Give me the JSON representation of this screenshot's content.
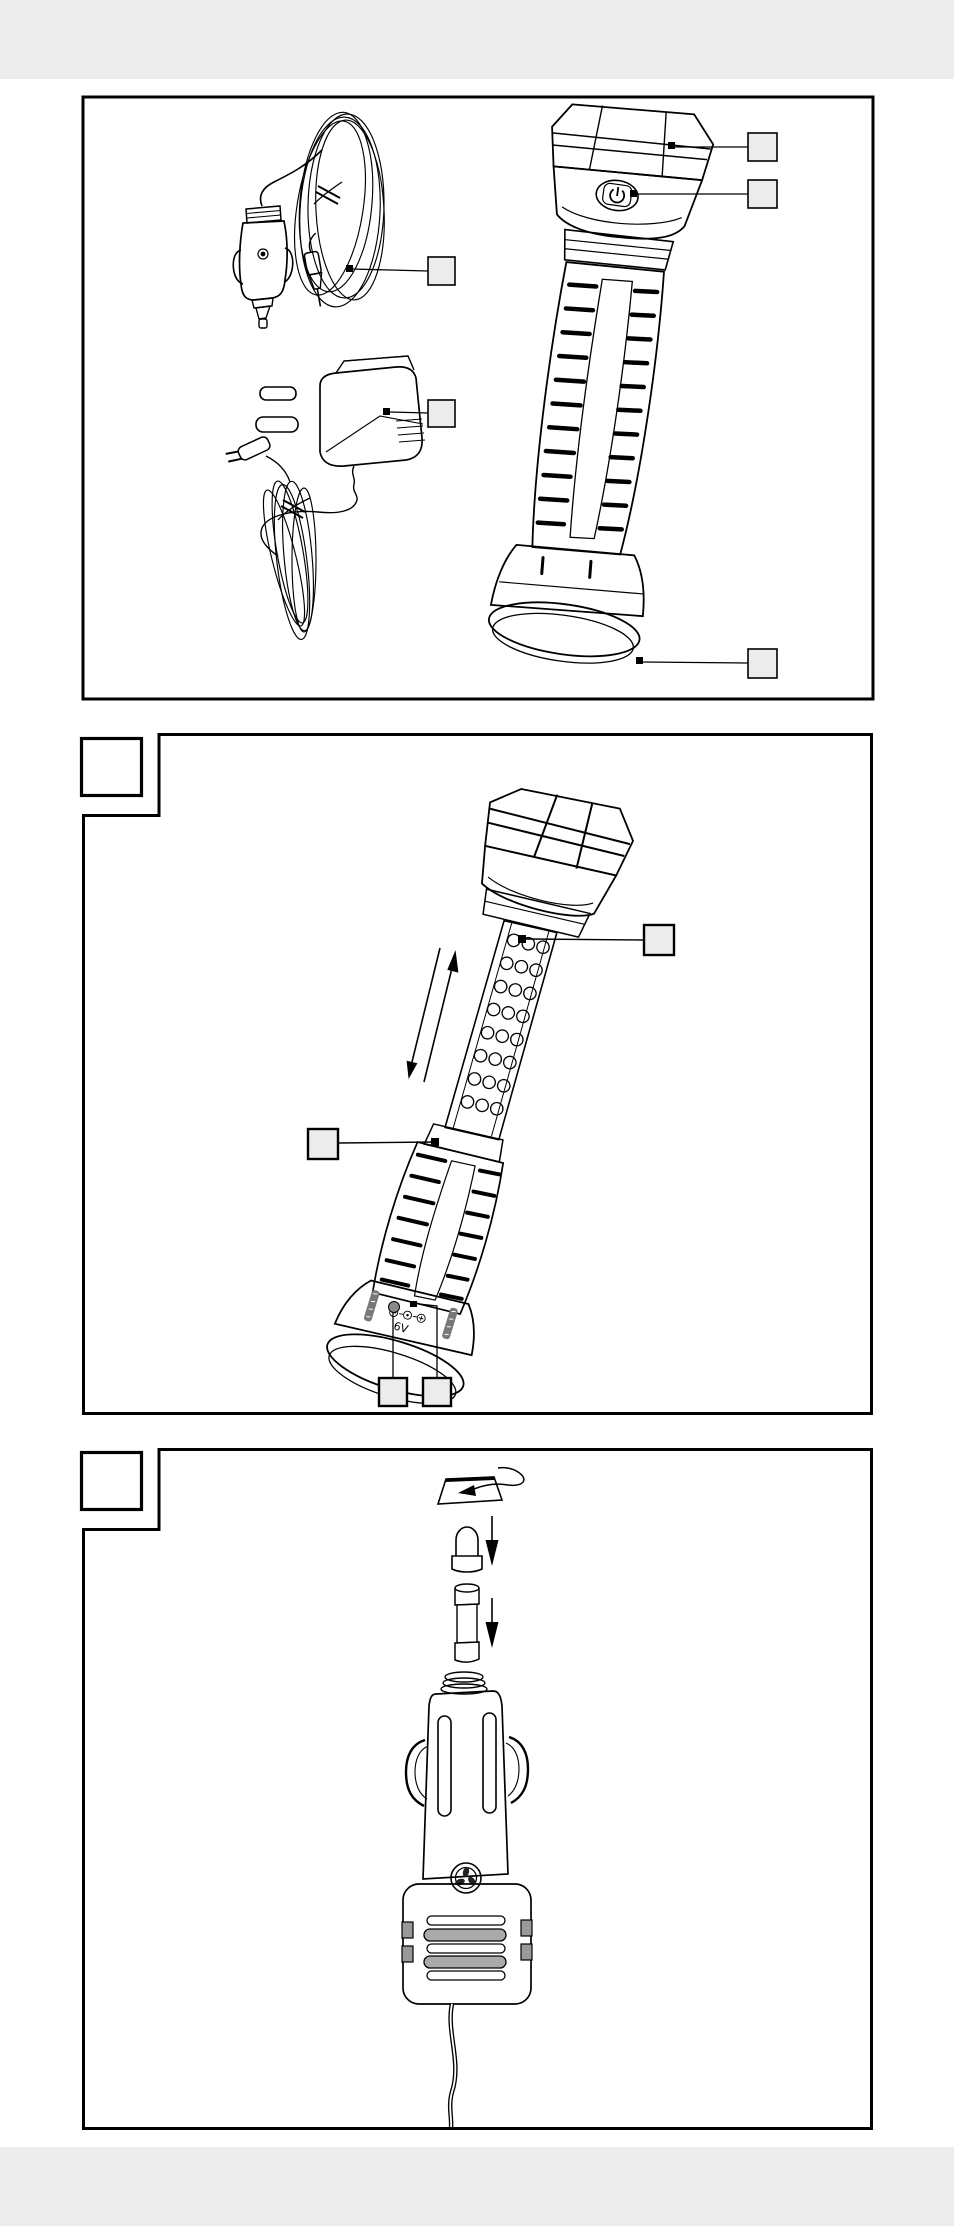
{
  "page": {
    "background": "#ffffff",
    "header_band_color": "#ededed",
    "footer_band_color": "#ededed"
  },
  "colors": {
    "line": "#000000",
    "callout_fill": "#ececec",
    "panel_fill": "#ffffff",
    "panel_border": "#000000"
  },
  "figures": [
    {
      "name": "parts-overview",
      "corner_label": "",
      "items": [
        "car-charger-with-coiled-cable",
        "mains-adapter-with-coiled-cable",
        "flashlight"
      ],
      "callouts": [
        {
          "target": "flashlight-head",
          "label": ""
        },
        {
          "target": "power-button",
          "label": ""
        },
        {
          "target": "car-charger-cable",
          "label": ""
        },
        {
          "target": "mains-adapter",
          "label": ""
        },
        {
          "target": "tail-cap",
          "label": ""
        }
      ]
    },
    {
      "name": "telescopic-extension",
      "corner_label": "",
      "items": [
        "flashlight-extended",
        "led-tube",
        "slide-direction-arrows"
      ],
      "callouts": [
        {
          "target": "led-tube",
          "label": ""
        },
        {
          "target": "grip-sleeve",
          "label": ""
        },
        {
          "target": "charging-socket",
          "label": ""
        },
        {
          "target": "socket-detail",
          "label": ""
        }
      ],
      "cap_marking": {
        "polarity_symbols": "⊖ ⊙ ⊕",
        "voltage": "6V"
      }
    },
    {
      "name": "fuse-replacement",
      "corner_label": "",
      "items": [
        "knurled-nut",
        "spring-tip",
        "fuse",
        "car-charger-plug"
      ],
      "callouts": []
    }
  ],
  "icons": {
    "power_button": "power-symbol",
    "slide_arrows": "up-down-arrows",
    "unscrew_arrow": "rotate-left-arrow",
    "insert_arrows": "down-arrow"
  }
}
